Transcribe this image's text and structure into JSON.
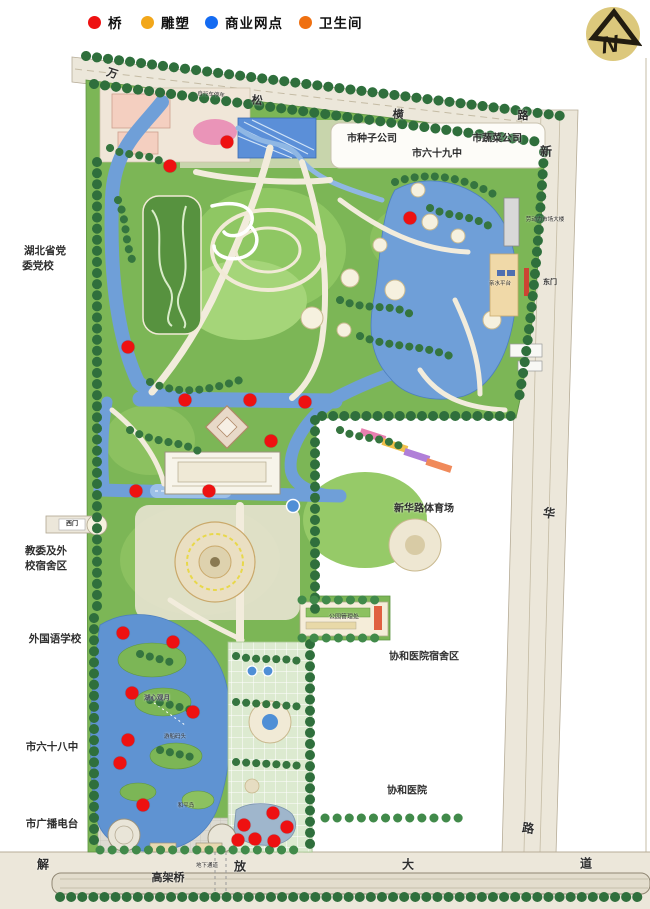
{
  "legend": {
    "items": [
      {
        "name": "bridge",
        "label": "桥",
        "color": "#ee1111",
        "x": 88
      },
      {
        "name": "sculpture",
        "label": "雕塑",
        "color": "#f2a71a",
        "x": 141
      },
      {
        "name": "commercial",
        "label": "商业网点",
        "color": "#146bf2",
        "x": 205
      },
      {
        "name": "toilet",
        "label": "卫生间",
        "color": "#ef7011",
        "x": 299
      }
    ]
  },
  "logo": {
    "letter": "N"
  },
  "colors": {
    "park_green": "#7cb656",
    "lawn_green": "#9ccb6a",
    "dark_tree": "#2f6f3c",
    "tree2": "#418a4a",
    "water": "#6f9fd8",
    "lake": "#5f93d2",
    "road": "#ece7da",
    "road_line": "#b7ad98",
    "plaza": "#e8e3d2",
    "bridge_red": "#ee1111"
  },
  "labels": [
    {
      "name": "road-wan",
      "text": "万",
      "x": 112,
      "y": 74,
      "size": 11,
      "rot": 18,
      "weight": 600
    },
    {
      "name": "road-song",
      "text": "松",
      "x": 257,
      "y": 101,
      "size": 11,
      "rot": 8,
      "weight": 600
    },
    {
      "name": "road-heng",
      "text": "横",
      "x": 398,
      "y": 115,
      "size": 11,
      "rot": 5,
      "weight": 600
    },
    {
      "name": "road-lu-north",
      "text": "路",
      "x": 523,
      "y": 116,
      "size": 11,
      "rot": 0,
      "weight": 600
    },
    {
      "name": "road-xin",
      "text": "新",
      "x": 546,
      "y": 152,
      "size": 12,
      "rot": 0,
      "weight": 600
    },
    {
      "name": "road-hua",
      "text": "华",
      "x": 549,
      "y": 514,
      "size": 12,
      "rot": 8,
      "weight": 600
    },
    {
      "name": "road-lu-east",
      "text": "路",
      "x": 528,
      "y": 829,
      "size": 12,
      "rot": 8,
      "weight": 600
    },
    {
      "name": "road-dao",
      "text": "道",
      "x": 586,
      "y": 864,
      "size": 12,
      "rot": 0,
      "weight": 600
    },
    {
      "name": "road-jie",
      "text": "解",
      "x": 43,
      "y": 865,
      "size": 12,
      "rot": 0,
      "weight": 600
    },
    {
      "name": "road-fang",
      "text": "放",
      "x": 240,
      "y": 867,
      "size": 12,
      "rot": 0,
      "weight": 600
    },
    {
      "name": "road-da",
      "text": "大",
      "x": 408,
      "y": 865,
      "size": 12,
      "rot": 0,
      "weight": 600
    },
    {
      "name": "road-gaojiaqiao",
      "text": "高架桥",
      "x": 168,
      "y": 878,
      "size": 11,
      "rot": 0,
      "weight": 600
    },
    {
      "name": "bike-parking",
      "text": "自行车停车",
      "x": 211,
      "y": 95,
      "size": 5.5,
      "rot": 4,
      "weight": 400
    },
    {
      "name": "hubei-party-school-1",
      "text": "湖北省党",
      "x": 45,
      "y": 252,
      "size": 10.5,
      "rot": 0,
      "weight": 700
    },
    {
      "name": "hubei-party-school-2",
      "text": "委党校",
      "x": 38,
      "y": 267,
      "size": 10.5,
      "rot": 0,
      "weight": 700
    },
    {
      "name": "seed-company",
      "text": "市种子公司",
      "x": 372,
      "y": 139,
      "size": 10,
      "rot": 0,
      "weight": 700
    },
    {
      "name": "vegetable-company",
      "text": "市蔬菜公司",
      "x": 497,
      "y": 139,
      "size": 10,
      "rot": 0,
      "weight": 700
    },
    {
      "name": "school-69",
      "text": "市六十九中",
      "x": 437,
      "y": 154,
      "size": 10,
      "rot": 0,
      "weight": 700
    },
    {
      "name": "edu-dorm-1",
      "text": "教委及外",
      "x": 46,
      "y": 552,
      "size": 10.5,
      "rot": 0,
      "weight": 700
    },
    {
      "name": "edu-dorm-2",
      "text": "校宿舍区",
      "x": 46,
      "y": 567,
      "size": 10.5,
      "rot": 0,
      "weight": 700
    },
    {
      "name": "foreign-language-school",
      "text": "外国语学校",
      "x": 55,
      "y": 640,
      "size": 10.5,
      "rot": 0,
      "weight": 700
    },
    {
      "name": "school-68",
      "text": "市六十八中",
      "x": 52,
      "y": 748,
      "size": 10.5,
      "rot": 0,
      "weight": 700
    },
    {
      "name": "radio-station",
      "text": "市广播电台",
      "x": 52,
      "y": 825,
      "size": 10.5,
      "rot": 0,
      "weight": 700
    },
    {
      "name": "xinhua-stadium",
      "text": "新华路体育场",
      "x": 424,
      "y": 509,
      "size": 10,
      "rot": 0,
      "weight": 700
    },
    {
      "name": "xiehe-dorm",
      "text": "协和医院宿舍区",
      "x": 424,
      "y": 657,
      "size": 10,
      "rot": 0,
      "weight": 700
    },
    {
      "name": "xiehe-hospital",
      "text": "协和医院",
      "x": 407,
      "y": 791,
      "size": 10,
      "rot": 0,
      "weight": 700
    },
    {
      "name": "labor-market-building",
      "text": "劳动力市场大楼",
      "x": 545,
      "y": 220,
      "size": 5.5,
      "rot": 0,
      "weight": 400
    },
    {
      "name": "east-gate",
      "text": "东门",
      "x": 550,
      "y": 283,
      "size": 7,
      "rot": 0,
      "weight": 600
    },
    {
      "name": "west-gate",
      "text": "西门",
      "x": 72,
      "y": 525,
      "size": 6,
      "rot": 0,
      "weight": 600
    },
    {
      "name": "waterfront-platform",
      "text": "亲水平台",
      "x": 500,
      "y": 284,
      "size": 5.5,
      "rot": 0,
      "weight": 400
    },
    {
      "name": "park-office",
      "text": "公园管理处",
      "x": 344,
      "y": 618,
      "size": 6,
      "rot": 0,
      "weight": 400
    },
    {
      "name": "lake-heart-moon",
      "text": "湖心观月",
      "x": 157,
      "y": 698,
      "size": 6.5,
      "rot": 0,
      "weight": 600,
      "color": "#4a4a5a"
    },
    {
      "name": "peace-island",
      "text": "和平岛",
      "x": 186,
      "y": 806,
      "size": 5.5,
      "rot": 0,
      "weight": 400
    },
    {
      "name": "boat-dock",
      "text": "游船码头",
      "x": 175,
      "y": 737,
      "size": 5.5,
      "rot": 0,
      "weight": 400
    },
    {
      "name": "underpass",
      "text": "地下通道",
      "x": 207,
      "y": 866,
      "size": 5.5,
      "rot": 0,
      "weight": 400
    }
  ],
  "markers": {
    "bridges": [
      [
        227,
        142
      ],
      [
        170,
        166
      ],
      [
        410,
        218
      ],
      [
        128,
        347
      ],
      [
        185,
        400
      ],
      [
        250,
        400
      ],
      [
        305,
        402
      ],
      [
        271,
        441
      ],
      [
        136,
        491
      ],
      [
        209,
        491
      ],
      [
        123,
        633
      ],
      [
        173,
        642
      ],
      [
        132,
        693
      ],
      [
        193,
        712
      ],
      [
        128,
        740
      ],
      [
        120,
        763
      ],
      [
        143,
        805
      ],
      [
        273,
        813
      ],
      [
        244,
        825
      ],
      [
        287,
        827
      ],
      [
        238,
        840
      ],
      [
        255,
        839
      ],
      [
        274,
        841
      ]
    ]
  }
}
